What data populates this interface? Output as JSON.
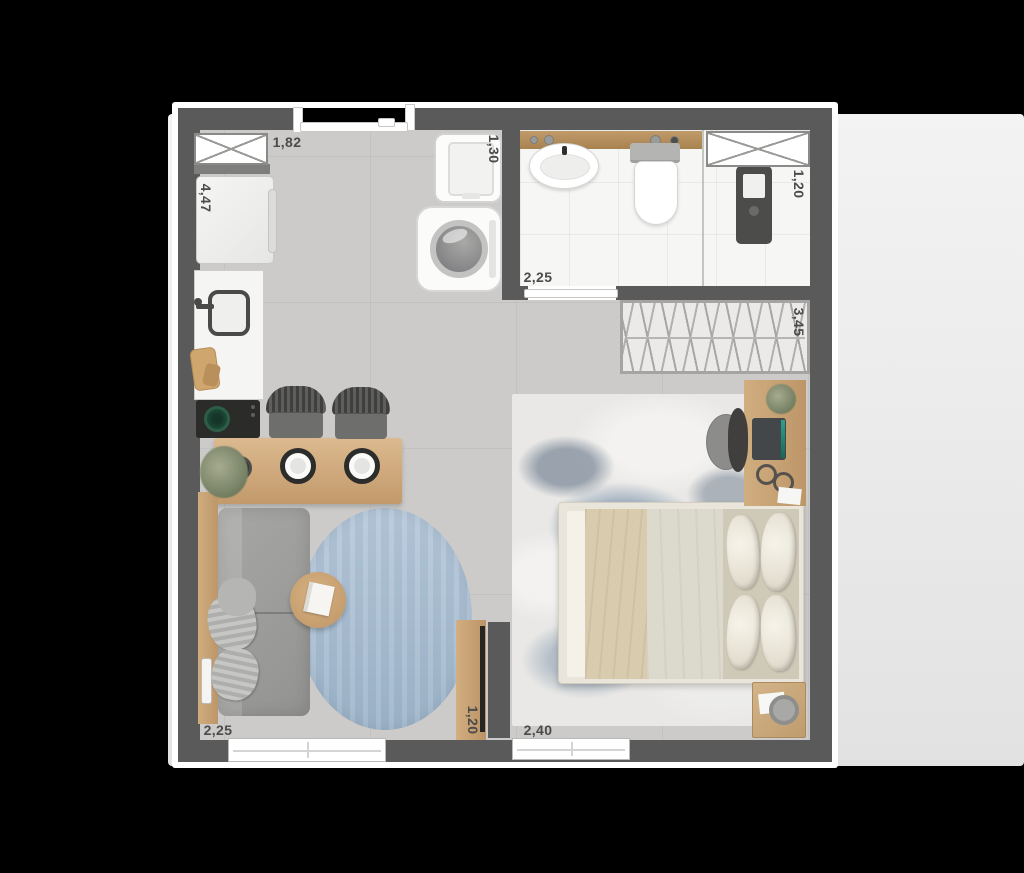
{
  "plan": {
    "type": "studio-apartment-floor-plan",
    "dimensions": {
      "entry_top": "1,82",
      "kitchen_side": "4,47",
      "laundry": "1,30",
      "bathroom_width": "2,25",
      "shower_width": "1,20",
      "closet_length": "3,45",
      "living_width": "2,25",
      "tv_wall": "1,20",
      "bedroom_width": "2,40"
    }
  },
  "colors": {
    "background": "#000000",
    "page": "#ededed",
    "wall": "#5a5a5a",
    "floor": "#cccbc9",
    "bathroom_floor": "#f6f6f4",
    "wood": "#c8a877",
    "wood_dark": "#b68d5c",
    "rug_blue": "#aabfd4",
    "bedroom_rug_base": "#e9e8e6",
    "sofa": "#9e9e9c",
    "fixture_white": "#fafaf9",
    "appliance_dark": "#2b2b29",
    "label_text": "#4b4b4b",
    "plant_green": "#8b9072",
    "pan_green": "#1d4a38"
  }
}
